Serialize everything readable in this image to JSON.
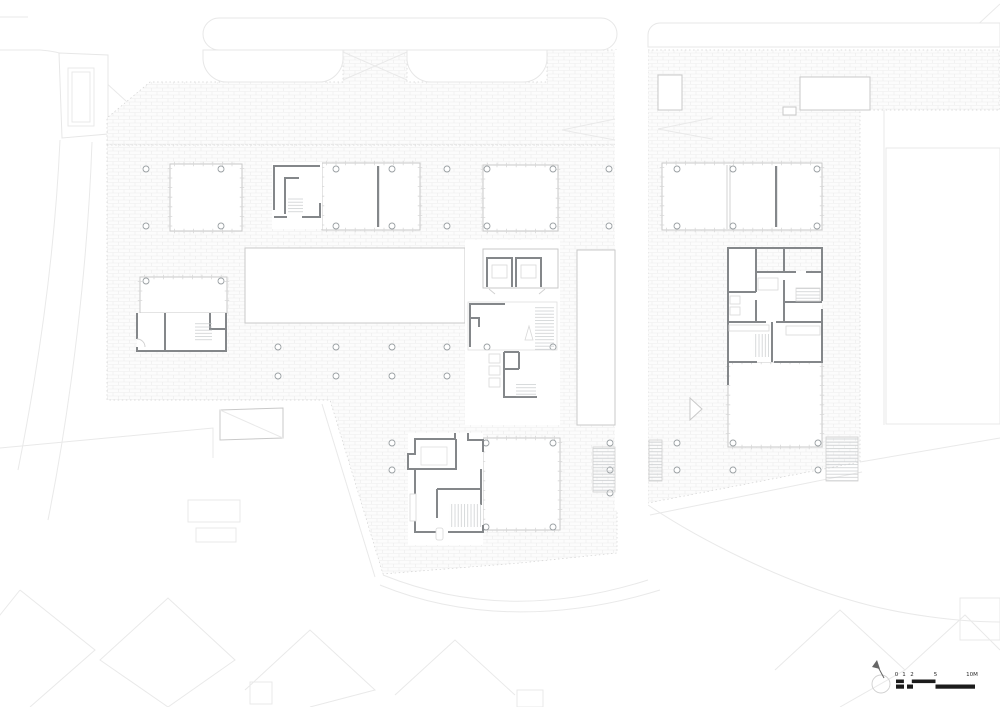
{
  "drawing": {
    "kind": "architectural floor plan"
  },
  "scale_bar": {
    "labels": [
      "0",
      "1",
      "2",
      "5",
      "10M"
    ]
  },
  "colors": {
    "background": "#ffffff",
    "hatch_line": "#ececec",
    "light_outline": "#c9c9c9",
    "context_line": "#e9e9e9",
    "wall": "#84878a",
    "column_outline": "#9aa0a3",
    "scale_bar_ink": "#1b1b1b"
  }
}
